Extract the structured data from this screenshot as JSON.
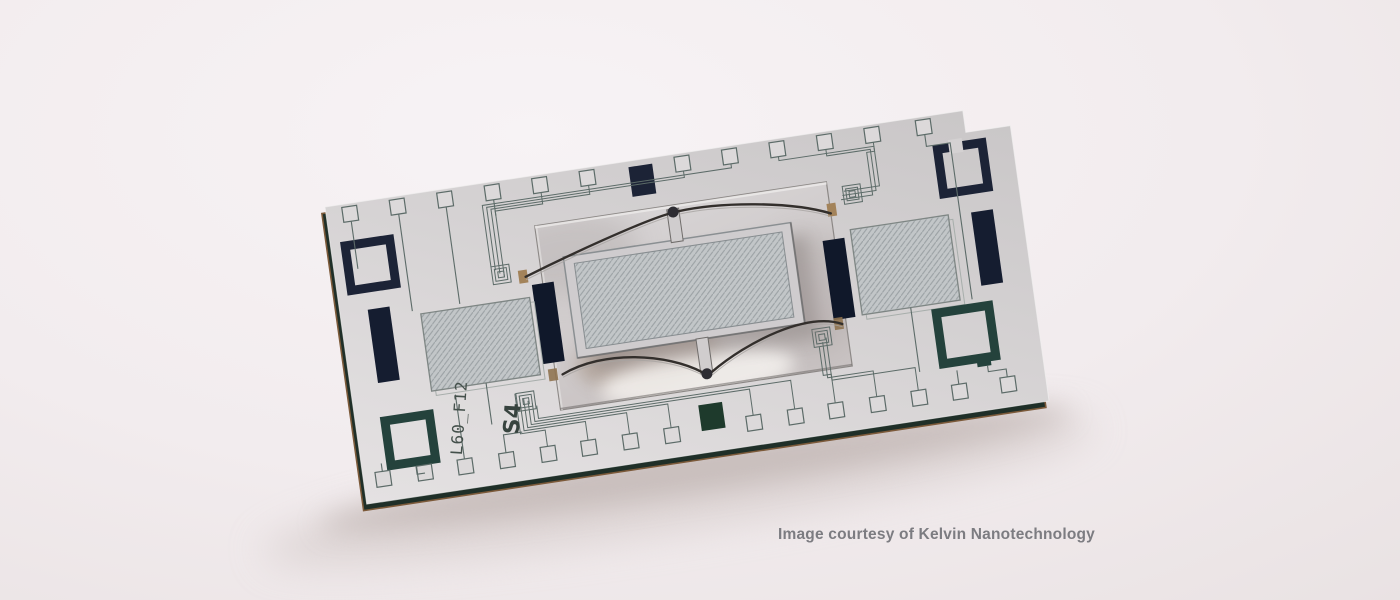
{
  "scene": {
    "description": "Studio photograph of a microfabricated MEMS chip (pale silicon die with dark metal markings, bond pads and a suspended central stage) resting tilted on a neutral pale surface",
    "object": "MEMS test-structure die"
  },
  "caption": {
    "text": "Image courtesy of Kelvin Nanotechnology",
    "color": "#7c7c81"
  },
  "chip": {
    "label_primary": "L60_F12",
    "label_secondary": "S4",
    "top_bond_pads": 12,
    "bottom_bond_pads": 15,
    "corner_frame_marks": 4,
    "dark_bars": 4,
    "hatched_regions": 3,
    "has_etched_window": true,
    "has_suspended_stage": true,
    "notch_corner": "top-right",
    "colors": {
      "die_face": "#d6d3d4",
      "die_edge": "#1f2f28",
      "edge_copper": "#7c5a3a",
      "navy_marks": "#1c2336",
      "teal_marks": "#24423c",
      "hatch_fill": "#c2c6c8",
      "trace": "#5c6b68",
      "anchor_pad": "#a3835a"
    }
  },
  "background": {
    "top": "#f6f2f4",
    "bottom": "#ded5d6"
  }
}
